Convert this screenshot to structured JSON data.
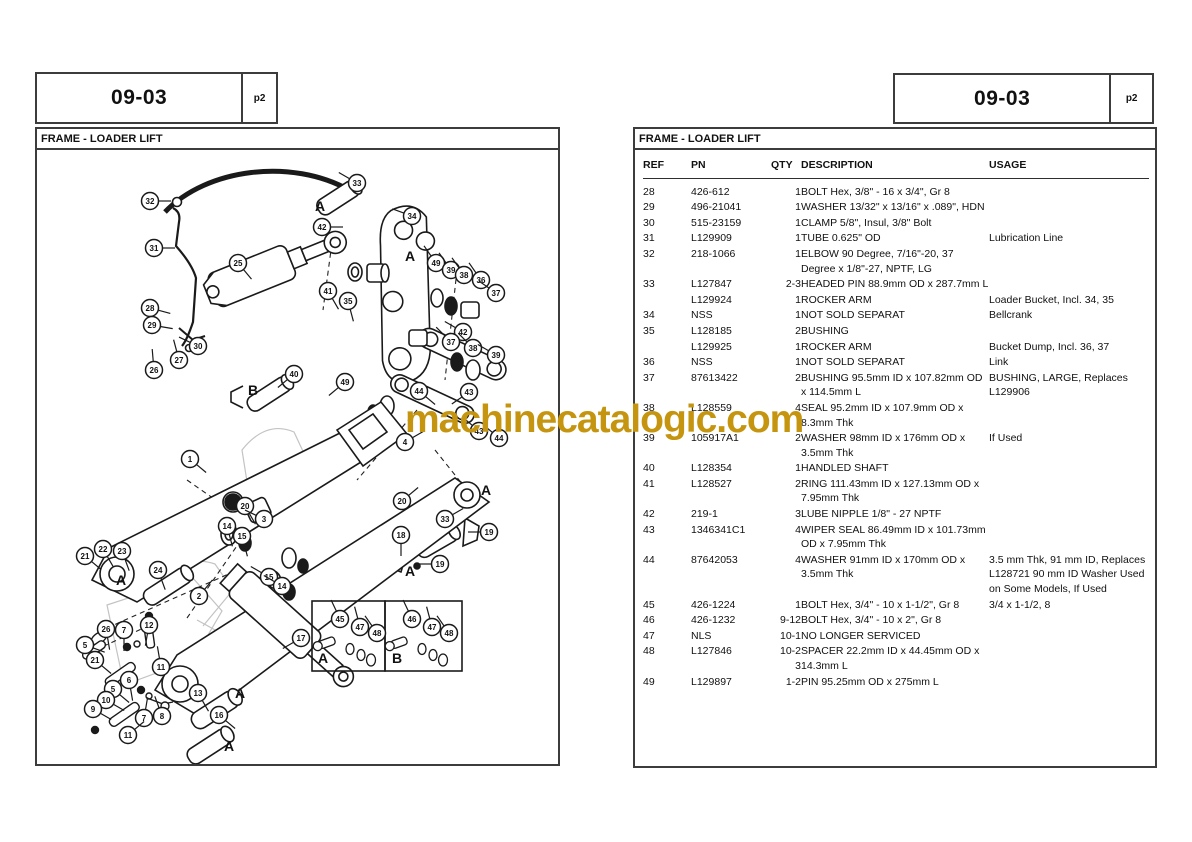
{
  "watermark": {
    "text": "machinecatalogic.com",
    "color": "#c5950f"
  },
  "left_page": {
    "header": {
      "section": "09-03",
      "page": "p2"
    },
    "title": "FRAME - LOADER LIFT",
    "diagram": {
      "insets": [
        {
          "label": "A",
          "parts": [
            "45",
            "47",
            "48"
          ]
        },
        {
          "label": "B",
          "parts": [
            "46",
            "47",
            "48"
          ]
        }
      ],
      "callouts": [
        {
          "n": "33",
          "x": 320,
          "y": 33,
          "a": 210
        },
        {
          "n": "32",
          "x": 113,
          "y": 51,
          "a": 0
        },
        {
          "n": "34",
          "x": 375,
          "y": 66,
          "a": 200
        },
        {
          "n": "42",
          "x": 285,
          "y": 77,
          "a": 0
        },
        {
          "n": "31",
          "x": 117,
          "y": 98,
          "a": 0
        },
        {
          "n": "25",
          "x": 201,
          "y": 113,
          "a": 50
        },
        {
          "n": "49",
          "x": 399,
          "y": 113,
          "a": 235
        },
        {
          "n": "39",
          "x": 414,
          "y": 120,
          "a": 235
        },
        {
          "n": "38",
          "x": 427,
          "y": 125,
          "a": 235
        },
        {
          "n": "36",
          "x": 444,
          "y": 130,
          "a": 235
        },
        {
          "n": "37",
          "x": 459,
          "y": 143,
          "a": 215
        },
        {
          "n": "41",
          "x": 291,
          "y": 141,
          "a": 60
        },
        {
          "n": "35",
          "x": 311,
          "y": 151,
          "a": 75
        },
        {
          "n": "28",
          "x": 113,
          "y": 158,
          "a": 15
        },
        {
          "n": "29",
          "x": 115,
          "y": 175,
          "a": 10
        },
        {
          "n": "30",
          "x": 161,
          "y": 196,
          "a": 205
        },
        {
          "n": "27",
          "x": 142,
          "y": 210,
          "a": 255
        },
        {
          "n": "26",
          "x": 117,
          "y": 220,
          "a": 265
        },
        {
          "n": "40",
          "x": 257,
          "y": 224,
          "a": 140
        },
        {
          "n": "49",
          "x": 308,
          "y": 232,
          "a": 140
        },
        {
          "n": "42",
          "x": 426,
          "y": 182,
          "a": 210
        },
        {
          "n": "37",
          "x": 414,
          "y": 192,
          "a": 225
        },
        {
          "n": "38",
          "x": 436,
          "y": 198,
          "a": 225
        },
        {
          "n": "39",
          "x": 459,
          "y": 205,
          "a": 210
        },
        {
          "n": "44",
          "x": 382,
          "y": 241,
          "a": 40
        },
        {
          "n": "43",
          "x": 432,
          "y": 242,
          "a": 145
        },
        {
          "n": "4",
          "x": 368,
          "y": 292,
          "a": 330
        },
        {
          "n": "43",
          "x": 442,
          "y": 281,
          "a": 220
        },
        {
          "n": "44",
          "x": 462,
          "y": 288,
          "a": 220
        },
        {
          "n": "1",
          "x": 153,
          "y": 309,
          "a": 40
        },
        {
          "n": "20",
          "x": 208,
          "y": 356,
          "a": 60
        },
        {
          "n": "3",
          "x": 227,
          "y": 369,
          "a": 205
        },
        {
          "n": "14",
          "x": 190,
          "y": 376,
          "a": 75
        },
        {
          "n": "15",
          "x": 205,
          "y": 386,
          "a": 75
        },
        {
          "n": "21",
          "x": 48,
          "y": 406,
          "a": 40
        },
        {
          "n": "22",
          "x": 66,
          "y": 399,
          "a": 60
        },
        {
          "n": "23",
          "x": 85,
          "y": 401,
          "a": 70
        },
        {
          "n": "24",
          "x": 121,
          "y": 420,
          "a": 70
        },
        {
          "n": "2",
          "x": 162,
          "y": 446,
          "a": 310
        },
        {
          "n": "15",
          "x": 232,
          "y": 427,
          "a": 210
        },
        {
          "n": "14",
          "x": 245,
          "y": 436,
          "a": 210
        },
        {
          "n": "20",
          "x": 365,
          "y": 351,
          "a": 320
        },
        {
          "n": "33",
          "x": 408,
          "y": 369,
          "a": 330
        },
        {
          "n": "19",
          "x": 452,
          "y": 382,
          "a": 180
        },
        {
          "n": "18",
          "x": 364,
          "y": 385,
          "a": 90
        },
        {
          "n": "19",
          "x": 403,
          "y": 414,
          "a": 180
        },
        {
          "n": "17",
          "x": 264,
          "y": 488,
          "a": 150
        },
        {
          "n": "12",
          "x": 112,
          "y": 475,
          "a": 100
        },
        {
          "n": "26",
          "x": 69,
          "y": 479,
          "a": 80
        },
        {
          "n": "7",
          "x": 87,
          "y": 480,
          "a": 90
        },
        {
          "n": "5",
          "x": 48,
          "y": 495,
          "a": 20
        },
        {
          "n": "21",
          "x": 58,
          "y": 510,
          "a": 40
        },
        {
          "n": "11",
          "x": 124,
          "y": 517,
          "a": 260
        },
        {
          "n": "6",
          "x": 92,
          "y": 530,
          "a": 80
        },
        {
          "n": "5",
          "x": 76,
          "y": 539,
          "a": 40
        },
        {
          "n": "10",
          "x": 69,
          "y": 550,
          "a": 30
        },
        {
          "n": "9",
          "x": 56,
          "y": 559,
          "a": 30
        },
        {
          "n": "7",
          "x": 107,
          "y": 568,
          "a": 280
        },
        {
          "n": "8",
          "x": 125,
          "y": 566,
          "a": 250
        },
        {
          "n": "11",
          "x": 91,
          "y": 585,
          "a": 320
        },
        {
          "n": "13",
          "x": 161,
          "y": 543,
          "a": 60
        },
        {
          "n": "16",
          "x": 182,
          "y": 565,
          "a": 40
        },
        {
          "n": "45",
          "x": 303,
          "y": 469,
          "a": 245
        },
        {
          "n": "47",
          "x": 323,
          "y": 477,
          "a": 255
        },
        {
          "n": "48",
          "x": 340,
          "y": 483,
          "a": 235
        },
        {
          "n": "46",
          "x": 375,
          "y": 469,
          "a": 245
        },
        {
          "n": "47",
          "x": 395,
          "y": 477,
          "a": 255
        },
        {
          "n": "48",
          "x": 412,
          "y": 483,
          "a": 235
        }
      ],
      "letters": [
        {
          "t": "A",
          "x": 278,
          "y": 61
        },
        {
          "t": "A",
          "x": 368,
          "y": 111
        },
        {
          "t": "A",
          "x": 444,
          "y": 345
        },
        {
          "t": "A",
          "x": 368,
          "y": 426
        },
        {
          "t": "A",
          "x": 79,
          "y": 435
        },
        {
          "t": "A",
          "x": 198,
          "y": 548
        },
        {
          "t": "A",
          "x": 187,
          "y": 601
        },
        {
          "t": "B",
          "x": 211,
          "y": 245
        },
        {
          "t": "A",
          "x": 281,
          "y": 513
        },
        {
          "t": "B",
          "x": 355,
          "y": 513
        }
      ]
    }
  },
  "right_page": {
    "header": {
      "section": "09-03",
      "page": "p2"
    },
    "title": "FRAME - LOADER LIFT",
    "table": {
      "columns": [
        "REF",
        "PN",
        "QTY",
        "DESCRIPTION",
        "USAGE"
      ],
      "rows": [
        {
          "ref": "28",
          "pn": "426-612",
          "qty": "1",
          "desc": "BOLT Hex, 3/8\" - 16 x 3/4\", Gr 8",
          "usage": ""
        },
        {
          "ref": "29",
          "pn": "496-21041",
          "qty": "1",
          "desc": "WASHER 13/32\" x 13/16\" x .089\", HDN",
          "usage": ""
        },
        {
          "ref": "30",
          "pn": "515-23159",
          "qty": "1",
          "desc": "CLAMP 5/8\", Insul, 3/8\" Bolt",
          "usage": ""
        },
        {
          "ref": "31",
          "pn": "L129909",
          "qty": "1",
          "desc": "TUBE 0.625\" OD",
          "usage": "Lubrication Line"
        },
        {
          "ref": "32",
          "pn": "218-1066",
          "qty": "1",
          "desc": "ELBOW 90 Degree, 7/16\"-20, 37 Degree x 1/8\"-27, NPTF, LG",
          "usage": ""
        },
        {
          "ref": "33",
          "pn": "L127847",
          "qty": "2-3",
          "desc": "HEADED PIN 88.9mm OD x 287.7mm L",
          "usage": ""
        },
        {
          "ref": "",
          "pn": "L129924",
          "qty": "1",
          "desc": "ROCKER ARM",
          "usage": "Loader Bucket, Incl. 34, 35"
        },
        {
          "ref": "34",
          "pn": "NSS",
          "qty": "1",
          "desc": "NOT SOLD SEPARAT",
          "usage": "Bellcrank"
        },
        {
          "ref": "35",
          "pn": "L128185",
          "qty": "2",
          "desc": "BUSHING",
          "usage": ""
        },
        {
          "ref": "",
          "pn": "L129925",
          "qty": "1",
          "desc": "ROCKER ARM",
          "usage": "Bucket Dump, Incl. 36, 37"
        },
        {
          "ref": "36",
          "pn": "NSS",
          "qty": "1",
          "desc": "NOT SOLD SEPARAT",
          "usage": "Link"
        },
        {
          "ref": "37",
          "pn": "87613422",
          "qty": "2",
          "desc": "BUSHING 95.5mm ID x 107.82mm OD x 114.5mm L",
          "usage": "BUSHING, LARGE,  Replaces L129906"
        },
        {
          "ref": "38",
          "pn": "L128559",
          "qty": "4",
          "desc": "SEAL 95.2mm ID x 107.9mm OD x 8.3mm Thk",
          "usage": ""
        },
        {
          "ref": "39",
          "pn": "105917A1",
          "qty": "2",
          "desc": "WASHER 98mm ID x 176mm OD x 3.5mm Thk",
          "usage": "If Used"
        },
        {
          "ref": "40",
          "pn": "L128354",
          "qty": "1",
          "desc": "HANDLED SHAFT",
          "usage": ""
        },
        {
          "ref": "41",
          "pn": "L128527",
          "qty": "2",
          "desc": "RING 111.43mm ID x 127.13mm OD x 7.95mm Thk",
          "usage": ""
        },
        {
          "ref": "42",
          "pn": "219-1",
          "qty": "3",
          "desc": "LUBE NIPPLE 1/8\" - 27 NPTF",
          "usage": ""
        },
        {
          "ref": "43",
          "pn": "1346341C1",
          "qty": "4",
          "desc": "WIPER SEAL 86.49mm ID x 101.73mm OD x 7.95mm Thk",
          "usage": ""
        },
        {
          "ref": "44",
          "pn": "87642053",
          "qty": "4",
          "desc": "WASHER 91mm ID x 170mm OD x 3.5mm Thk",
          "usage": "3.5 mm Thk, 91 mm ID, Replaces L128721 90 mm ID Washer Used on Some Models,  If Used"
        },
        {
          "ref": "45",
          "pn": "426-1224",
          "qty": "1",
          "desc": "BOLT Hex, 3/4\" - 10 x 1-1/2\", Gr 8",
          "usage": "3/4 x 1-1/2, 8"
        },
        {
          "ref": "46",
          "pn": "426-1232",
          "qty": "9-12",
          "desc": "BOLT Hex, 3/4\" - 10 x 2\", Gr 8",
          "usage": ""
        },
        {
          "ref": "47",
          "pn": "NLS",
          "qty": "10-1",
          "desc": "NO LONGER SERVICED",
          "usage": ""
        },
        {
          "ref": "48",
          "pn": "L127846",
          "qty": "10-2\n3",
          "desc": "SPACER 22.2mm ID x 44.45mm OD x 14.3mm L",
          "usage": ""
        },
        {
          "ref": "49",
          "pn": "L129897",
          "qty": "1-2",
          "desc": "PIN 95.25mm OD x 275mm L",
          "usage": ""
        }
      ]
    }
  }
}
